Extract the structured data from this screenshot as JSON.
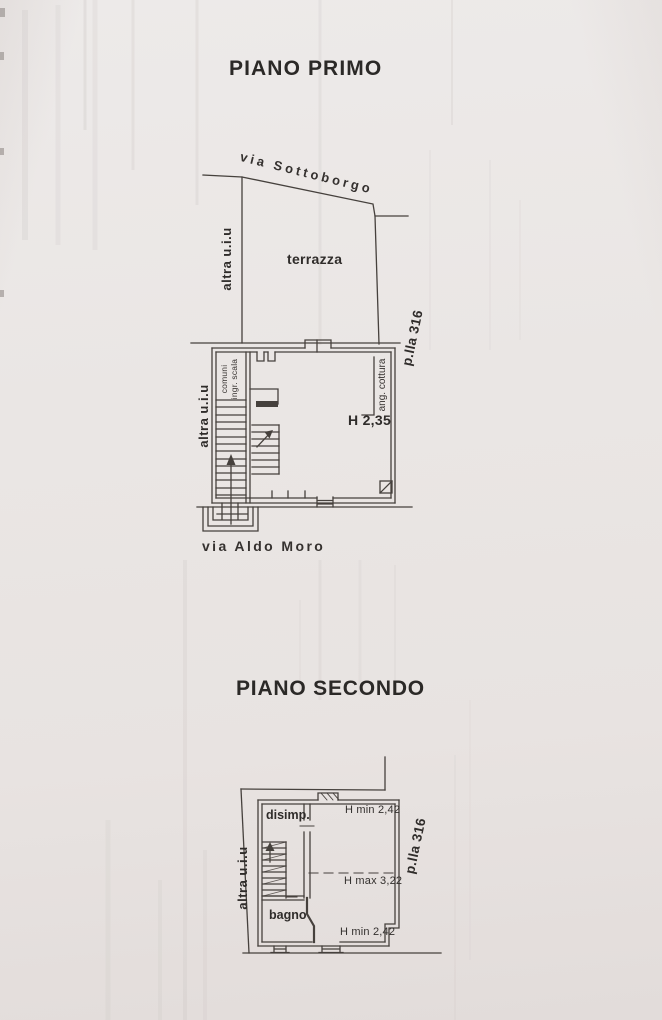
{
  "piano_primo": {
    "title": "PIANO PRIMO",
    "street_top": "via Sottoborgo",
    "street_bottom": "via Aldo Moro",
    "terrace_label": "terrazza",
    "adjacent_unit_top": "altra u.i.u",
    "adjacent_unit_left": "altra u.i.u",
    "parcel_label": "p.lla 316",
    "stair_label_line1": "ingr. scala",
    "stair_label_line2": "comuni",
    "room_height": "H 2,35",
    "cooking_corner": "ang. cottura"
  },
  "piano_secondo": {
    "title": "PIANO SECONDO",
    "adjacent_unit_left": "altra u.i.u",
    "parcel_label": "p.lla 316",
    "hallway_label": "disimp.",
    "bathroom_label": "bagno",
    "height_min_top": "H min 2,42",
    "height_max_mid": "H max 3,22",
    "height_min_bottom": "H min 2,42"
  }
}
